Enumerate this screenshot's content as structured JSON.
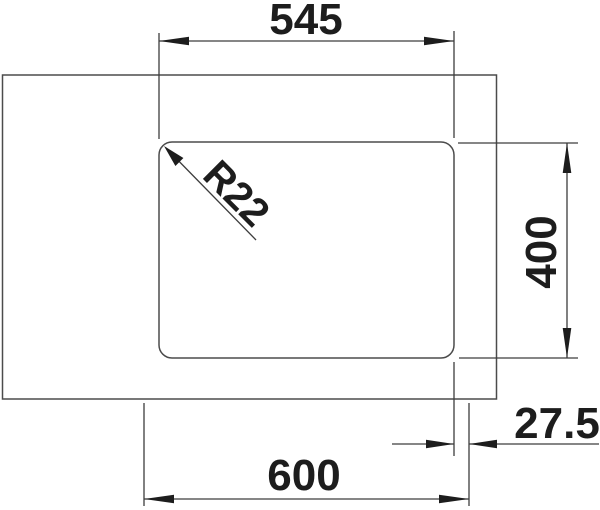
{
  "drawing": {
    "title": "sink-installation-dimension-drawing",
    "colors": {
      "background": "#ffffff",
      "line": "#4b4b4b",
      "dimension_line": "#3d3d3d",
      "text": "#1d1d1d"
    },
    "labels": {
      "top_width": "545",
      "side_height": "400",
      "right_offset": "27.5",
      "bottom_width": "600",
      "corner_radius": "R22"
    }
  }
}
